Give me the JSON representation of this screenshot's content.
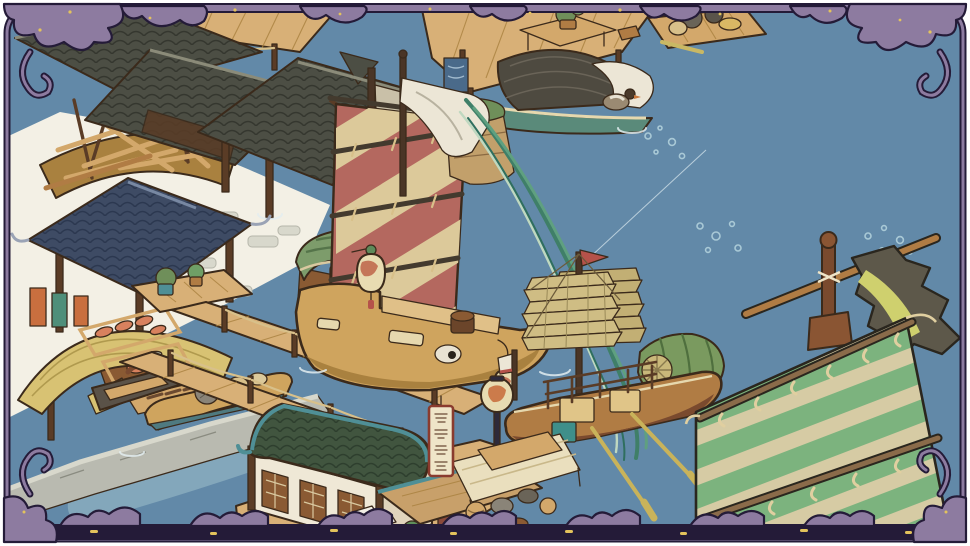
{
  "scene": {
    "description": "hand-painted isometric canal-town harbor game scene inside an ornamental scroll frame",
    "sign_text": "飛雲茶舍",
    "objects": {
      "frame": "ornamental purple scroll frame with gold speckles",
      "water": "calm river water",
      "shipyard": "boat under construction beside dark tiled workshop roofs",
      "dock_pavilion": "dark-roof pavilion on stilts over the water",
      "hanging_lantern": "gold lantern hanging from pavilion eave",
      "blue_roof_pavilion": "pavilion with dark blue tiled roof",
      "drying_cloths": "dyed cloths hanging to dry",
      "thatched_stall": "market stall with curved thatch awning",
      "fish_racks": "bamboo racks with drying fish and eel",
      "straw_piles": "bundles of straw",
      "stone_embankment": "grey stone quay wall",
      "moored_boats": "small cargo rowboats moored at the quay",
      "piers": "wooden plank walkways with rope-linked posts",
      "pier_plants": "potted plants on pier platform",
      "red_sail_ship": "merchant ship with red and cream striped batten sail, painted eye and lanterns",
      "banner_streamers": "white banner with long green ribbon streamers",
      "stone_pillar": "mossy stone pillar in the water",
      "junk_boat": "junk with tan batten sails, red pennant, green stern canopy and oars",
      "covered_boat": "green-hulled boat with woven canopy, white cloth and a goose",
      "supply_raft": "small raft loaded with goods",
      "dock_table": "dock table with bonsai plant",
      "teahouse": "waterfront house with green rounded tile roof and lattice windows",
      "dock_sign": "vertical wooden shop sign",
      "street_lantern": "round painted lantern on a post",
      "market_awning": "cream fabric awning over goods",
      "green_sail": "foreground green and cream striped sail with bamboo battens",
      "tattered_banner": "weathered dark banner with yellow stripe",
      "fishing_line": "thin fishing line over the water",
      "bubbles": "clusters of bubbles on the water"
    }
  },
  "colors": {
    "water": "#6289a8",
    "waterLight": "#9fbfca",
    "shore": "#f3f0e5",
    "stone": "#b9bab0",
    "stoneLight": "#d8d8cc",
    "frame": "#8d7ba0",
    "frameDark": "#241b38",
    "gold": "#e3c35c",
    "white": "#ffffff",
    "roofDark": "#4c4e44",
    "roofDarkLine": "#35372f",
    "roofBlue": "#3e4b64",
    "roofBlueLine": "#2c3850",
    "roofGreen": "#41553f",
    "roofGreenLine": "#2e3f2e",
    "teal": "#4f8f96",
    "woodDark": "#5a3c26",
    "wood": "#b07c44",
    "woodLight": "#d3a86b",
    "plank": "#d8b077",
    "hull": "#cfa45e",
    "hullShadow": "#a9813f",
    "deck": "#e0c088",
    "sailRed": "#b4685f",
    "sailCream": "#dcc99a",
    "batten": "#433a2e",
    "sailTan": "#cfbd84",
    "sailTanDark": "#c2af74",
    "sailTanLine": "#9a8a58",
    "sailGreen": "#7cb37e",
    "sailStripe": "#d6cba4",
    "canopyGreen": "#7d9c6b",
    "canopyDark": "#55744a",
    "wovenDark": "#4e4a40",
    "bannerDark": "#5d584a",
    "bannerYellow": "#cfd06e",
    "lantern": "#e8dcb2",
    "lanternRed": "#c06a4e",
    "lanternGreen": "#5e8a5a",
    "lanternGold": "#d9b864",
    "cloth": "#ece6d6",
    "streamer": "#3f7f68",
    "streamerLight": "#5fa080",
    "straw": "#d8c273",
    "fish": "#d8815e",
    "rope": "#d8c08a",
    "pennant": "#b5524a",
    "rock": "#c2a06b",
    "moss": "#6f8f5a",
    "wall": "#efe8d6",
    "signRed": "#8a3b2e",
    "outline": "#3b2a1b",
    "ink": "#2a261e"
  }
}
